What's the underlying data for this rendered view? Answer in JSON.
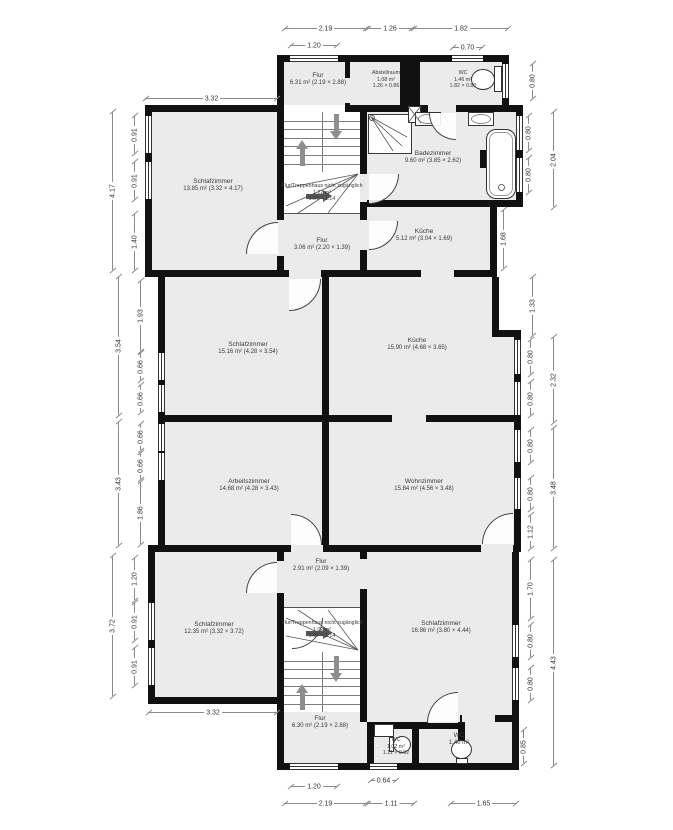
{
  "colors": {
    "wall": "#111111",
    "room_fill": "#ebebeb",
    "background": "#ffffff",
    "dimension_line": "#8a8a8a",
    "stair_arrow": "#8e8e8e",
    "landing_arrow": "#555555"
  },
  "rooms": [
    {
      "id": "flur-og-nord",
      "name": "Flur",
      "area": "6.31 m² (2.19 × 2.88)"
    },
    {
      "id": "abstellraum",
      "name": "Abstellraum",
      "area": "1.08 m²",
      "wh": "1.26 × 0.86"
    },
    {
      "id": "wc-nord",
      "name": "WC",
      "area": "1.46 m²",
      "wh": "1.82 × 0.80"
    },
    {
      "id": "schlafzimmer-nw",
      "name": "Schlafzimmer",
      "area": "13.85 m² (3.32 × 4.17)"
    },
    {
      "id": "badezimmer",
      "name": "Badezimmer",
      "area": "9.60 m² (3.85 × 2.62)"
    },
    {
      "id": "treppenhaus-nord",
      "name": "Flur/Treppenhaus nicht zugänglich",
      "area": "1.22 m²",
      "wh": "1.07 × 1.14"
    },
    {
      "id": "flur-mitte",
      "name": "Flur",
      "area": "3.06 m² (2.20 × 1.39)"
    },
    {
      "id": "kueche-klein",
      "name": "Küche",
      "area": "5.12 m² (3.04 × 1.69)"
    },
    {
      "id": "schlafzimmer-mitte",
      "name": "Schlafzimmer",
      "area": "15.16 m² (4.28 × 3.54)"
    },
    {
      "id": "kueche-gross",
      "name": "Küche",
      "area": "15.90 m² (4.68 × 3.65)"
    },
    {
      "id": "arbeitszimmer",
      "name": "Arbeitszimmer",
      "area": "14.68 m² (4.28 × 3.43)"
    },
    {
      "id": "wohnzimmer",
      "name": "Wohnzimmer",
      "area": "15.84 m² (4.56 × 3.48)"
    },
    {
      "id": "flur-klein",
      "name": "Flur",
      "area": "2.91 m² (2.09 × 1.39)"
    },
    {
      "id": "schlafzimmer-sw",
      "name": "Schlafzimmer",
      "area": "12.35 m² (3.32 × 3.72)"
    },
    {
      "id": "treppenhaus-sued",
      "name": "Flur/Treppenhaus nicht zugänglich",
      "area": "1.02 m²",
      "wh": "1.07 × 1.14"
    },
    {
      "id": "schlafzimmer-se",
      "name": "Schlafzimmer",
      "area": "16.86 m² (3.80 × 4.44)"
    },
    {
      "id": "flur-sued",
      "name": "Flur",
      "area": "6.30 m² (2.19 × 2.88)"
    },
    {
      "id": "wc-klein",
      "name": "WC",
      "area": "1.02 m²",
      "wh": "1.11 × 0.92"
    },
    {
      "id": "wc-sued",
      "name": "WC",
      "area": "1.40 m²"
    }
  ],
  "dims": [
    "2.19",
    "1.26",
    "1.82",
    "1.20",
    "0.70",
    "3.32",
    "4.17",
    "0.91",
    "0.91",
    "1.40",
    "3.54",
    "1.93",
    "0.66",
    "0.66",
    "3.43",
    "0.66",
    "0.66",
    "1.86",
    "3.72",
    "1.20",
    "0.91",
    "0.91",
    "3.32",
    "1.20",
    "0.64",
    "2.19",
    "1.11",
    "1.65",
    "0.80",
    "2.04",
    "0.80",
    "0.80",
    "1.68",
    "1.33",
    "2.32",
    "0.80",
    "0.80",
    "3.48",
    "0.80",
    "0.80",
    "1.12",
    "1.70",
    "4.43",
    "0.80",
    "0.80",
    "0.85"
  ]
}
